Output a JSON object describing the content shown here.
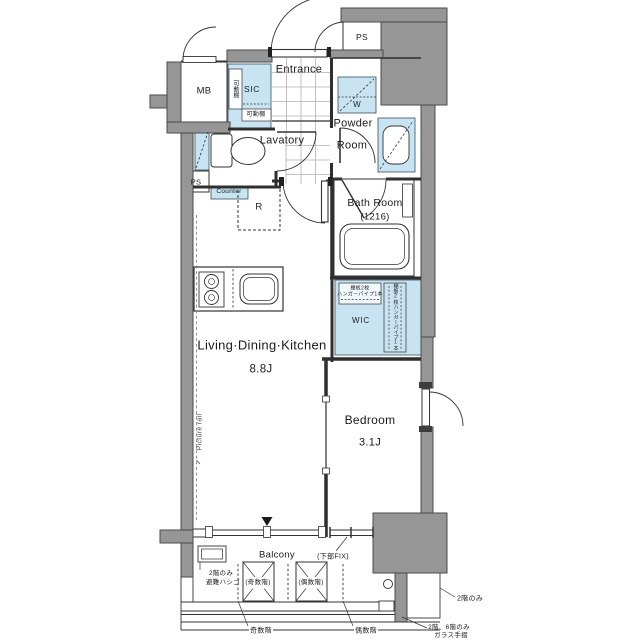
{
  "rooms": {
    "entrance": {
      "label": "Entrance"
    },
    "mb": {
      "label": "MB"
    },
    "ps_top": {
      "label": "PS"
    },
    "ps_side": {
      "label": "PS"
    },
    "sic": {
      "label": "SIC"
    },
    "washer": {
      "label": "W"
    },
    "powder": {
      "label_line1": "Powder",
      "label_line2": "Room"
    },
    "lavatory": {
      "label": "Lavatory"
    },
    "counter": {
      "label": "Counter"
    },
    "fridge": {
      "label": "R"
    },
    "bath": {
      "label": "Bath Room",
      "size": "(1216)"
    },
    "wic": {
      "label": "WIC"
    },
    "ldk": {
      "label": "Living·Dining·Kitchen",
      "size": "8.8J"
    },
    "bedroom": {
      "label": "Bedroom",
      "size": "3.1J"
    },
    "balcony": {
      "label": "Balcony"
    }
  },
  "annotations": {
    "sic_shelf_vertical": "可動棚",
    "sic_shelf_horizontal": "可動棚",
    "wic_shelf_line1": "棚板2枚",
    "wic_shelf_line2": "ハンガーパイプ1本",
    "wic_shelf_side": "棚板2枚ハンガーパイプ1本",
    "picture_rail": "Picture rail",
    "lower_fix": "(下部FIX)",
    "escape_ladder_line1": "2階のみ",
    "escape_ladder_line2": "避難ハシゴ",
    "ac_odd_floors": "(奇数階)",
    "ac_even_floors": "(偶数階)",
    "leader_odd_floors": "奇数階",
    "leader_even_floors": "偶数階",
    "second_floor_only": "2階のみ",
    "glass_rail_line1": "2階、6階のみ",
    "glass_rail_line2": "ガラス手摺"
  },
  "colors": {
    "structure_wall": "#969696",
    "fixture_fill": "#c8e3f2",
    "line": "#333333",
    "background": "#ffffff"
  }
}
